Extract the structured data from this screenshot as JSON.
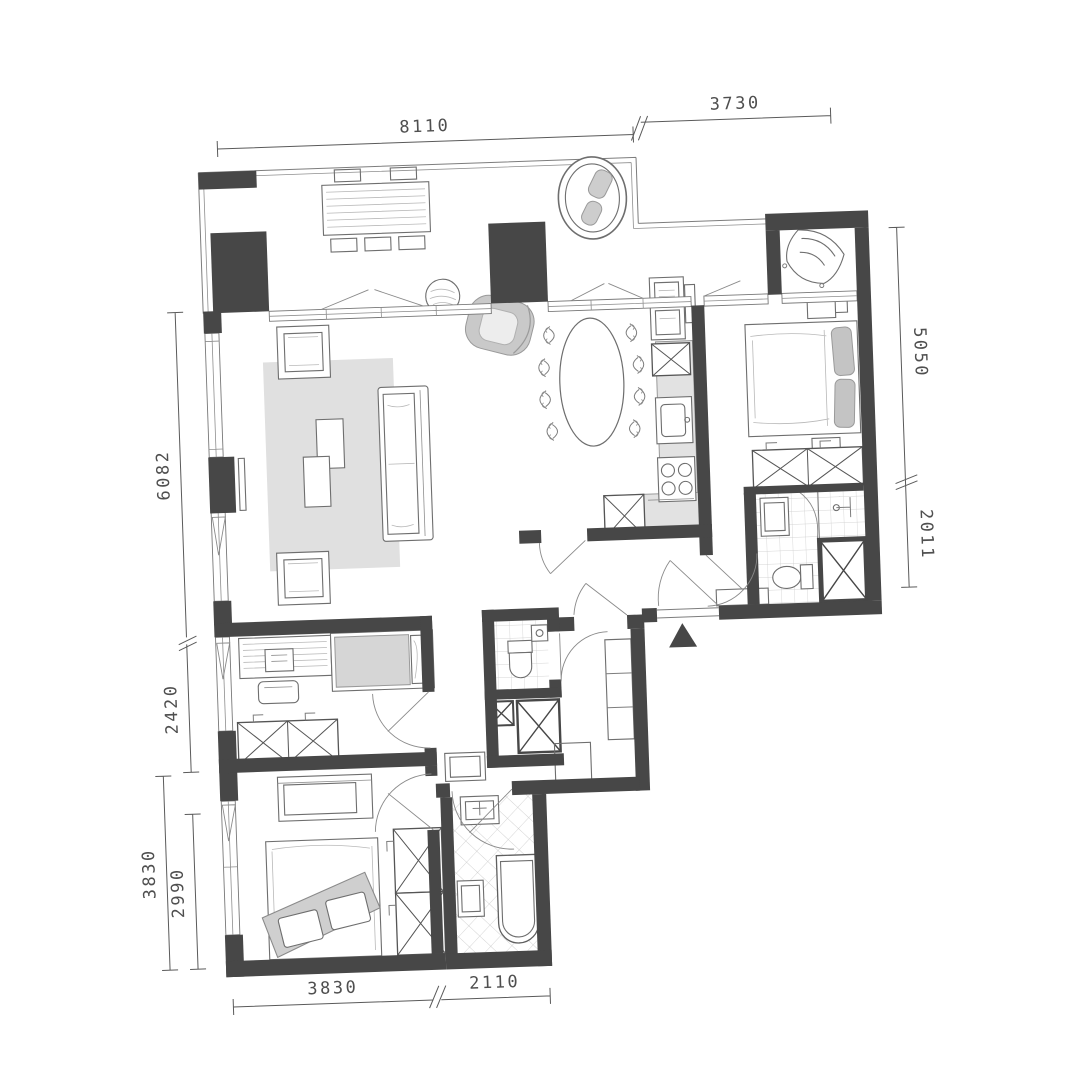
{
  "plan": {
    "type": "apartment-floor-plan",
    "dims": {
      "top": [
        {
          "label": "8110"
        },
        {
          "label": "3730"
        }
      ],
      "right": [
        {
          "label": "5050"
        },
        {
          "label": "2011"
        }
      ],
      "left": [
        {
          "label": "6082"
        },
        {
          "label": "2420"
        },
        {
          "label": "3830"
        },
        {
          "label": "2990"
        }
      ],
      "bottom": [
        {
          "label": "3830"
        },
        {
          "label": "2110"
        }
      ]
    },
    "icons": {
      "entrance_marker": "filled-triangle-up"
    },
    "colors": {
      "wall": "#474747",
      "counter": "#e2e2e2",
      "rug": "#e0e0e0",
      "soft_gray": "#cdcdcd",
      "line": "#7d7d7d",
      "dim_text": "#4f4f4f",
      "background": "#ffffff"
    }
  }
}
